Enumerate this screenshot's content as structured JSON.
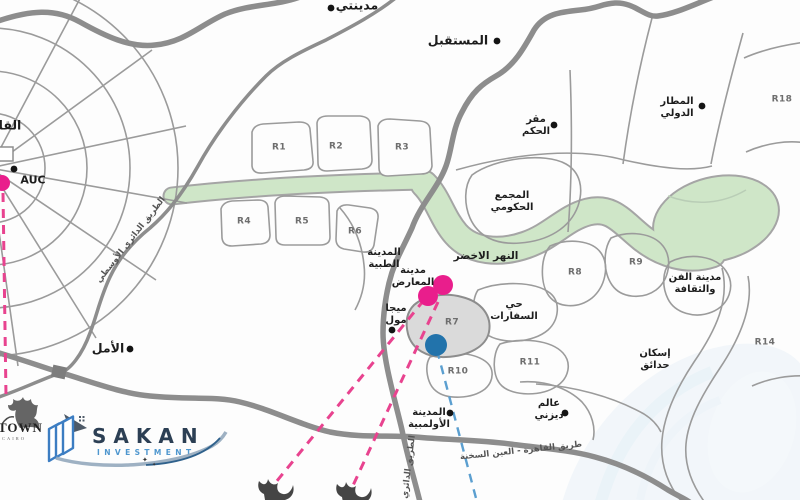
{
  "map": {
    "colors": {
      "dot": "#141414",
      "magenta": "#e91e8c",
      "blue": "#2273ab",
      "magenta_dash": "#e8438f",
      "blue_dash": "#5b9fd0",
      "green_river": "#cfe6c8",
      "road_major": "#8d8d8d",
      "road_minor": "#9b9b9b",
      "region_highlight": "#dadada"
    },
    "labels": [
      {
        "id": "madinaty",
        "text": "مدينتي",
        "x": 357,
        "y": 6,
        "kind": "place-lg"
      },
      {
        "id": "mostakbal",
        "text": "المستقبل",
        "x": 458,
        "y": 41,
        "kind": "place-lg"
      },
      {
        "id": "cairo-edge",
        "text": "القا",
        "x": 10,
        "y": 126,
        "kind": "place-lg"
      },
      {
        "id": "auc",
        "text": "AUC",
        "x": 33,
        "y": 181,
        "kind": "latin"
      },
      {
        "id": "amal",
        "text": "الأمل",
        "x": 108,
        "y": 349,
        "kind": "place-lg"
      },
      {
        "id": "middle-ring-road",
        "text": "الطريق الدائري الأوسطي",
        "x": 131,
        "y": 240,
        "kind": "road",
        "rotate": -52
      },
      {
        "id": "r1",
        "text": "R1",
        "x": 279,
        "y": 148,
        "kind": "code"
      },
      {
        "id": "r2",
        "text": "R2",
        "x": 336,
        "y": 147,
        "kind": "code"
      },
      {
        "id": "r3",
        "text": "R3",
        "x": 402,
        "y": 148,
        "kind": "code"
      },
      {
        "id": "r4",
        "text": "R4",
        "x": 244,
        "y": 222,
        "kind": "code"
      },
      {
        "id": "r5",
        "text": "R5",
        "x": 302,
        "y": 222,
        "kind": "code"
      },
      {
        "id": "r6",
        "text": "R6",
        "x": 355,
        "y": 232,
        "kind": "code"
      },
      {
        "id": "r7",
        "text": "R7",
        "x": 452,
        "y": 323,
        "kind": "code"
      },
      {
        "id": "r8",
        "text": "R8",
        "x": 575,
        "y": 273,
        "kind": "code"
      },
      {
        "id": "r9",
        "text": "R9",
        "x": 636,
        "y": 263,
        "kind": "code"
      },
      {
        "id": "r10",
        "text": "R10",
        "x": 458,
        "y": 372,
        "kind": "code"
      },
      {
        "id": "r11",
        "text": "R11",
        "x": 530,
        "y": 363,
        "kind": "code"
      },
      {
        "id": "r14",
        "text": "R14",
        "x": 765,
        "y": 343,
        "kind": "code"
      },
      {
        "id": "r18",
        "text": "R18",
        "x": 782,
        "y": 100,
        "kind": "code"
      },
      {
        "id": "medical-city",
        "text": "المدينة\nالطبية",
        "x": 384,
        "y": 259,
        "kind": "place"
      },
      {
        "id": "exhibition-city",
        "text": "مدينة\nالمعارض",
        "x": 413,
        "y": 277,
        "kind": "place"
      },
      {
        "id": "mega-mall",
        "text": "ميجا\nمول",
        "x": 396,
        "y": 315,
        "kind": "place"
      },
      {
        "id": "government-complex",
        "text": "المجمع\nالحكومي",
        "x": 512,
        "y": 202,
        "kind": "place"
      },
      {
        "id": "green-river",
        "text": "النهر الاخضر",
        "x": 486,
        "y": 256,
        "kind": "green"
      },
      {
        "id": "embassies-district",
        "text": "حي\nالسفارات",
        "x": 514,
        "y": 311,
        "kind": "place"
      },
      {
        "id": "arts-culture-city",
        "text": "مدينة الفن\nوالثقافة",
        "x": 695,
        "y": 284,
        "kind": "place"
      },
      {
        "id": "intl-airport",
        "text": "المطار\nالدولي",
        "x": 677,
        "y": 108,
        "kind": "place"
      },
      {
        "id": "seat-of-government",
        "text": "مقر\nالحكم",
        "x": 536,
        "y": 126,
        "kind": "place"
      },
      {
        "id": "olympic-city",
        "text": "المدينة\nالأولمبية",
        "x": 429,
        "y": 419,
        "kind": "place"
      },
      {
        "id": "disney-world",
        "text": "عالم\nديزني",
        "x": 549,
        "y": 410,
        "kind": "place"
      },
      {
        "id": "hadayek-housing",
        "text": "إسكان\nحدائق",
        "x": 655,
        "y": 360,
        "kind": "place"
      },
      {
        "id": "cairo-sokhna-road",
        "text": "طريق القاهرة - العين السخنة",
        "x": 521,
        "y": 451,
        "kind": "road",
        "rotate": -6
      },
      {
        "id": "regional-ring-road",
        "text": "الطريق الدائري",
        "x": 409,
        "y": 467,
        "kind": "road",
        "rotate": -83
      }
    ],
    "location_dots": [
      {
        "x": 331,
        "y": 8
      },
      {
        "x": 497,
        "y": 41
      },
      {
        "x": 554,
        "y": 125
      },
      {
        "x": 702,
        "y": 106
      },
      {
        "x": 14,
        "y": 169
      },
      {
        "x": 130,
        "y": 349
      },
      {
        "x": 392,
        "y": 330
      },
      {
        "x": 450,
        "y": 413
      },
      {
        "x": 565,
        "y": 413
      }
    ],
    "highlight_markers": [
      {
        "x": 443,
        "y": 285,
        "r": 10,
        "color": "magenta"
      },
      {
        "x": 428,
        "y": 296,
        "r": 10,
        "color": "magenta"
      },
      {
        "x": 2,
        "y": 183,
        "r": 8,
        "color": "magenta"
      },
      {
        "x": 436,
        "y": 345,
        "r": 11,
        "color": "blue"
      }
    ],
    "callout_lines": [
      {
        "x1": 3,
        "y1": 193,
        "x2": 6,
        "y2": 396,
        "color": "magenta"
      },
      {
        "x1": 424,
        "y1": 300,
        "x2": 272,
        "y2": 487,
        "color": "magenta"
      },
      {
        "x1": 438,
        "y1": 302,
        "x2": 350,
        "y2": 492,
        "color": "magenta"
      },
      {
        "x1": 437,
        "y1": 350,
        "x2": 477,
        "y2": 502,
        "color": "blue"
      }
    ]
  },
  "branding": {
    "sakan": {
      "title": "SAKAN",
      "subtitle": "INVESTMENT"
    },
    "uptown": {
      "title": "TOWN",
      "subtitle": "CAIRO"
    }
  }
}
